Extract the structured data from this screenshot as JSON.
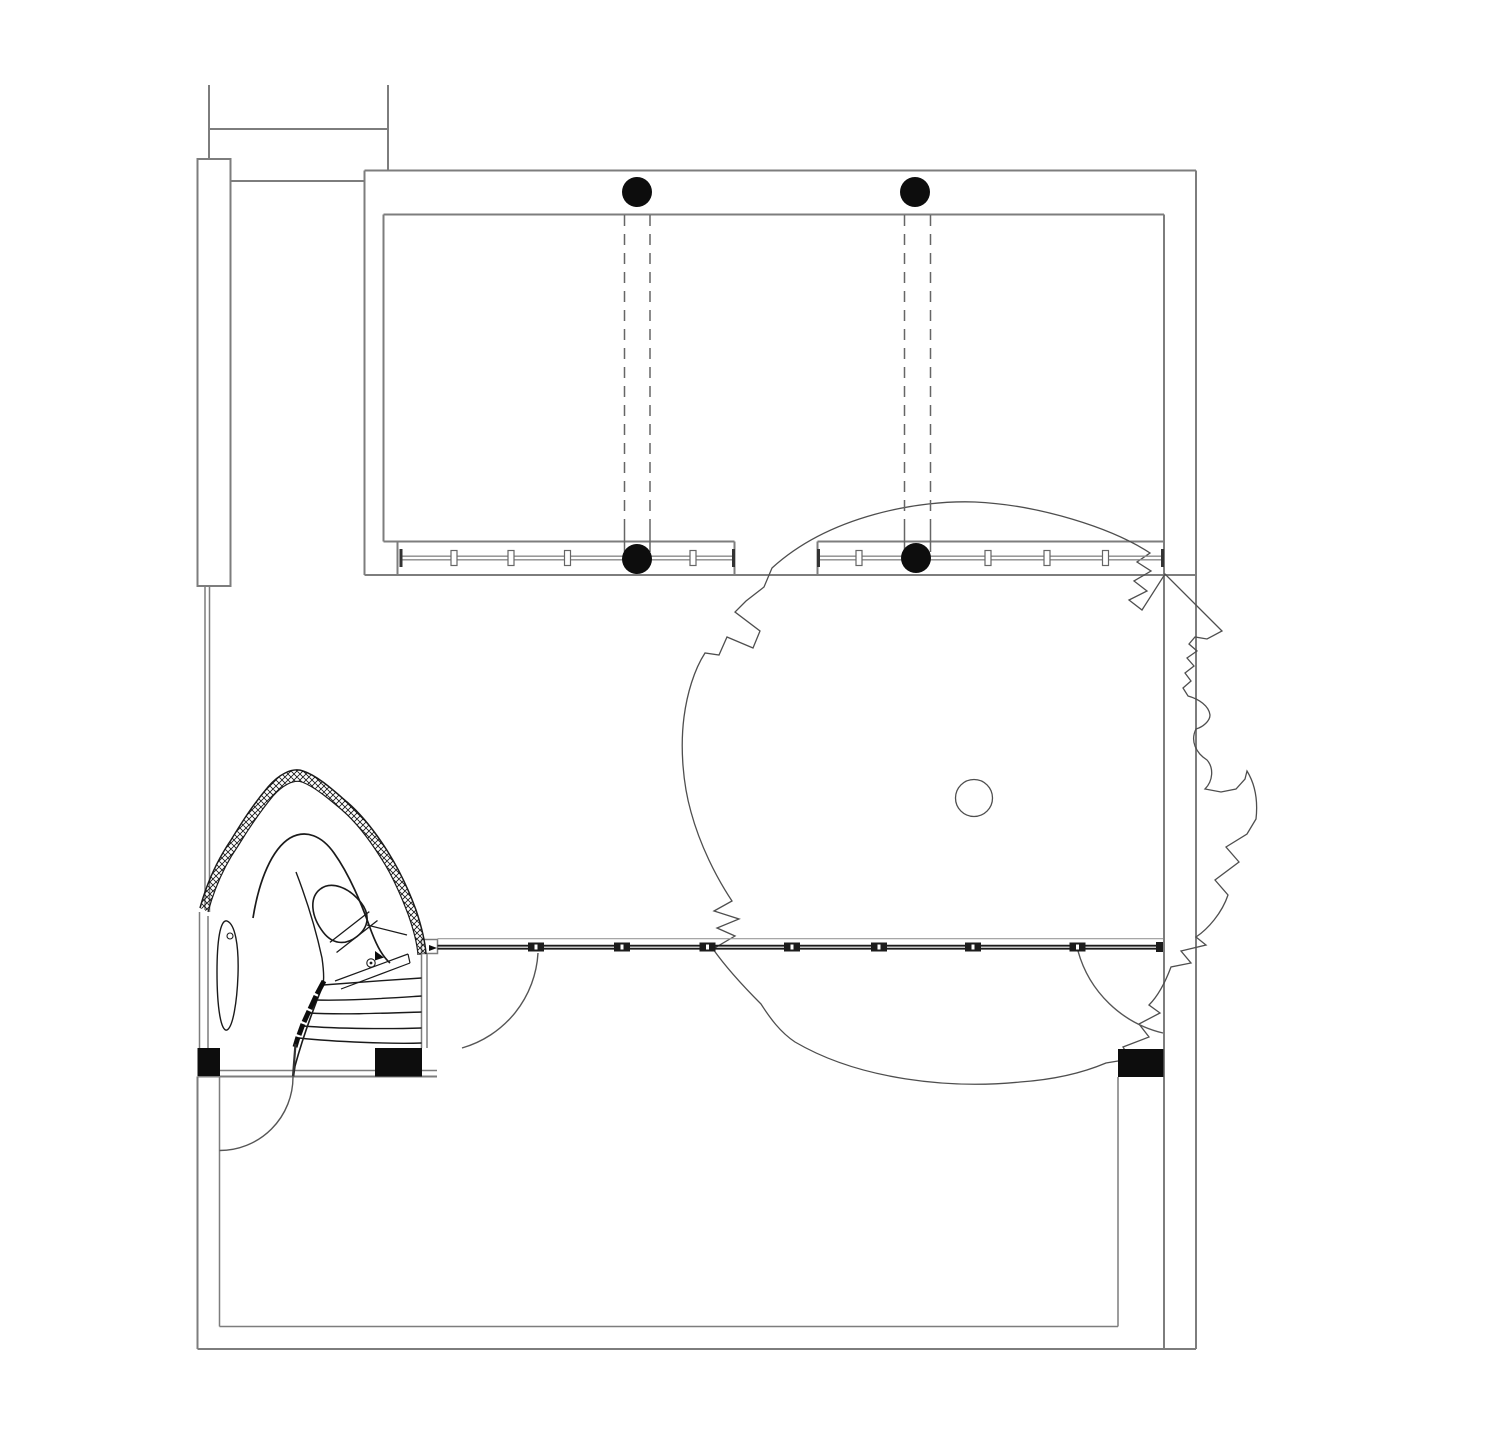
{
  "page": {
    "background": "#ffffff",
    "description": "Black-and-white architectural floor plan, no text labels"
  },
  "colors": {
    "wall": "#7d7d7d",
    "ink": "#1a1a1a",
    "tree_outline": "#4e4e4e",
    "solid_black": "#0d0d0d",
    "track_dark": "#1c1c1c",
    "marker_stroke": "#666666",
    "white": "#ffffff"
  },
  "plan": {
    "columns": [
      {
        "name": "column-top-left",
        "cx": 637,
        "cy": 192,
        "r": 15
      },
      {
        "name": "column-top-right",
        "cx": 915,
        "cy": 192,
        "r": 15
      },
      {
        "name": "column-track-left",
        "cx": 637,
        "cy": 559,
        "r": 15
      },
      {
        "name": "column-track-right",
        "cx": 916,
        "cy": 558,
        "r": 15
      }
    ],
    "upper_tracks": [
      {
        "name": "sliding-track-upper-left",
        "x1": 401,
        "x2": 733.5,
        "y": 558,
        "markers": [
          454,
          511,
          567.5,
          693
        ]
      },
      {
        "name": "sliding-track-upper-right",
        "x1": 818.5,
        "x2": 1162.5,
        "y": 558,
        "markers": [
          859,
          988,
          1047,
          1105.5
        ]
      }
    ],
    "lower_track": {
      "name": "sliding-track-lower",
      "x1": 437.5,
      "x2": 1163,
      "y": 947,
      "markers": [
        536,
        622,
        707.5,
        792,
        879,
        973,
        1077.5
      ]
    },
    "dashed_pairs": [
      {
        "name": "overhead-beam-left",
        "xs": [
          624.5,
          650
        ],
        "y1": 215,
        "y2": 520,
        "solid_to": 552
      },
      {
        "name": "overhead-beam-right",
        "xs": [
          904.5,
          930.5
        ],
        "y1": 215,
        "y2": 520,
        "solid_to": 552
      }
    ],
    "piers": [
      {
        "name": "black-pier-left",
        "x": 197.5,
        "y": 1048,
        "w": 22.5,
        "h": 28
      },
      {
        "name": "black-pier-middle",
        "x": 375,
        "y": 1048,
        "w": 47,
        "h": 28.5
      },
      {
        "name": "black-pier-right",
        "x": 1118,
        "y": 1049,
        "w": 45.5,
        "h": 28
      }
    ],
    "tree": {
      "trunk": {
        "cx": 974,
        "cy": 798,
        "r": 18.5
      }
    }
  }
}
